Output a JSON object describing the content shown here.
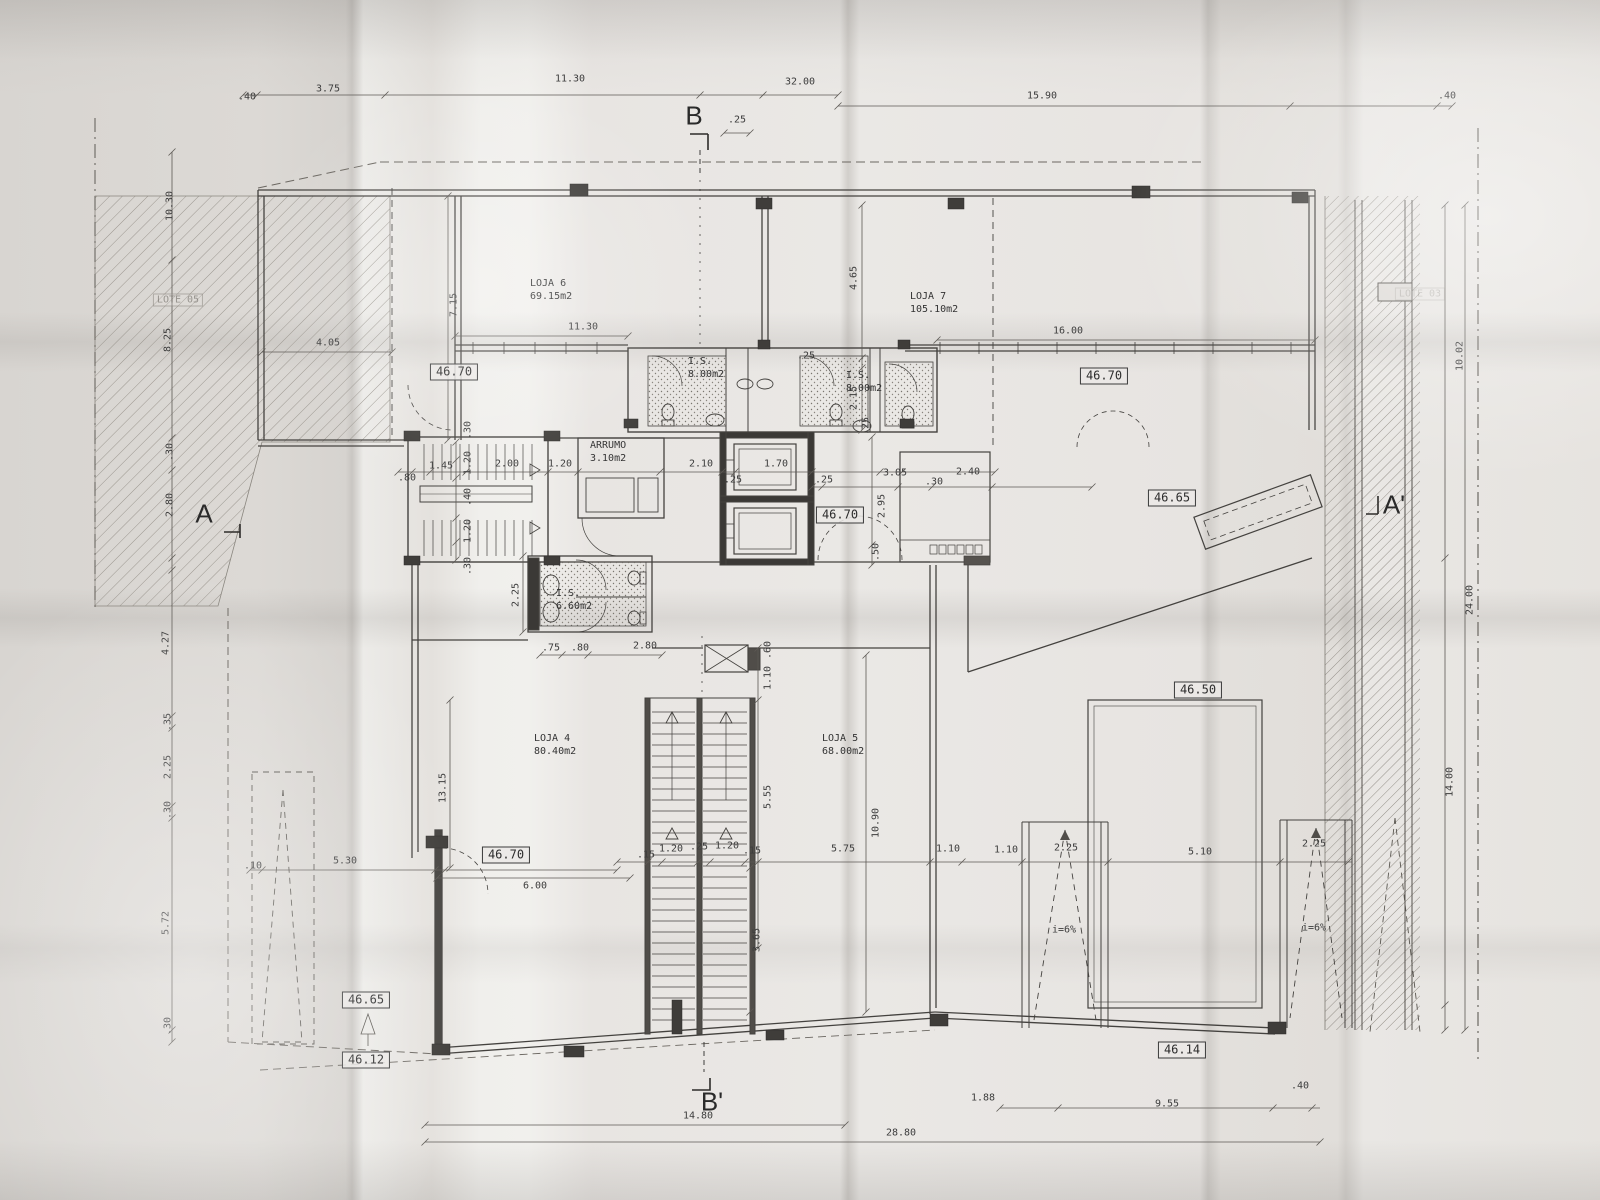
{
  "section_markers": [
    {
      "t": "B",
      "x": 694,
      "y": 116
    },
    {
      "t": "B'",
      "x": 712,
      "y": 1102
    },
    {
      "t": "A",
      "x": 204,
      "y": 514
    },
    {
      "t": "A'",
      "x": 1394,
      "y": 505
    }
  ],
  "room_labels": [
    {
      "t": "LOJA 6\n69.15m2",
      "x": 530,
      "y": 290
    },
    {
      "t": "LOJA 7\n105.10m2",
      "x": 910,
      "y": 303
    },
    {
      "t": "LOJA 4\n80.40m2",
      "x": 534,
      "y": 745
    },
    {
      "t": "LOJA 5\n68.00m2",
      "x": 822,
      "y": 745
    },
    {
      "t": "I.S.\n8.00m2",
      "x": 688,
      "y": 368
    },
    {
      "t": "I.S.\n8.00m2",
      "x": 846,
      "y": 382
    },
    {
      "t": "I.S.\n6.60m2",
      "x": 556,
      "y": 600
    },
    {
      "t": "ARRUMO\n3.10m2",
      "x": 590,
      "y": 452
    }
  ],
  "level_markers": [
    {
      "t": "46.70",
      "x": 454,
      "y": 372
    },
    {
      "t": "46.70",
      "x": 1104,
      "y": 376
    },
    {
      "t": "46.65",
      "x": 1172,
      "y": 498
    },
    {
      "t": "46.70",
      "x": 840,
      "y": 515
    },
    {
      "t": "46.50",
      "x": 1198,
      "y": 690
    },
    {
      "t": "46.70",
      "x": 506,
      "y": 855
    },
    {
      "t": "46.65",
      "x": 366,
      "y": 1000
    },
    {
      "t": "46.12",
      "x": 366,
      "y": 1060
    },
    {
      "t": "46.14",
      "x": 1182,
      "y": 1050
    }
  ],
  "lot_labels": [
    {
      "t": "LOTE 05",
      "x": 178,
      "y": 300,
      "o": 0.6
    },
    {
      "t": "LOTE 03",
      "x": 1420,
      "y": 294,
      "o": 0.3
    }
  ],
  "slope_labels": [
    {
      "t": "i=6%",
      "x": 1064,
      "y": 930
    },
    {
      "t": "i=6%",
      "x": 1314,
      "y": 928
    }
  ],
  "dims_h": [
    {
      "t": ".40",
      "x": 247,
      "y": 97
    },
    {
      "t": "3.75",
      "x": 328,
      "y": 89
    },
    {
      "t": "11.30",
      "x": 570,
      "y": 79
    },
    {
      "t": "32.00",
      "x": 800,
      "y": 82
    },
    {
      "t": ".25",
      "x": 737,
      "y": 120
    },
    {
      "t": "15.90",
      "x": 1042,
      "y": 96
    },
    {
      "t": ".40",
      "x": 1447,
      "y": 96
    },
    {
      "t": "4.05",
      "x": 328,
      "y": 343
    },
    {
      "t": "11.30",
      "x": 583,
      "y": 327
    },
    {
      "t": "16.00",
      "x": 1068,
      "y": 331
    },
    {
      "t": ".80",
      "x": 407,
      "y": 478
    },
    {
      "t": "1.45",
      "x": 441,
      "y": 466
    },
    {
      "t": "2.00",
      "x": 507,
      "y": 464
    },
    {
      "t": "1.20",
      "x": 560,
      "y": 464
    },
    {
      "t": "2.10",
      "x": 701,
      "y": 464
    },
    {
      "t": ".25",
      "x": 733,
      "y": 480
    },
    {
      "t": "1.70",
      "x": 776,
      "y": 464
    },
    {
      "t": ".25",
      "x": 806,
      "y": 356
    },
    {
      "t": ".25",
      "x": 824,
      "y": 480
    },
    {
      "t": "3.05",
      "x": 895,
      "y": 473
    },
    {
      "t": ".30",
      "x": 934,
      "y": 482
    },
    {
      "t": "2.40",
      "x": 968,
      "y": 472
    },
    {
      "t": ".75",
      "x": 551,
      "y": 648
    },
    {
      "t": ".80",
      "x": 580,
      "y": 648
    },
    {
      "t": "2.80",
      "x": 645,
      "y": 646
    },
    {
      "t": "5.30",
      "x": 345,
      "y": 861
    },
    {
      "t": ".10",
      "x": 253,
      "y": 866
    },
    {
      "t": "6.00",
      "x": 535,
      "y": 886
    },
    {
      "t": ".15",
      "x": 646,
      "y": 855
    },
    {
      "t": "1.20",
      "x": 671,
      "y": 849
    },
    {
      "t": ".25",
      "x": 699,
      "y": 847
    },
    {
      "t": "1.20",
      "x": 727,
      "y": 846
    },
    {
      "t": ".15",
      "x": 752,
      "y": 851
    },
    {
      "t": "5.75",
      "x": 843,
      "y": 849
    },
    {
      "t": "1.10",
      "x": 948,
      "y": 849
    },
    {
      "t": "1.10",
      "x": 1006,
      "y": 850
    },
    {
      "t": "2.25",
      "x": 1066,
      "y": 848
    },
    {
      "t": "5.10",
      "x": 1200,
      "y": 852
    },
    {
      "t": "2.25",
      "x": 1314,
      "y": 844
    },
    {
      "t": "1.88",
      "x": 983,
      "y": 1098
    },
    {
      "t": "9.55",
      "x": 1167,
      "y": 1104
    },
    {
      "t": ".40",
      "x": 1300,
      "y": 1086
    },
    {
      "t": "14.80",
      "x": 698,
      "y": 1116
    },
    {
      "t": "28.80",
      "x": 901,
      "y": 1133
    }
  ],
  "dims_v": [
    {
      "t": "10.30",
      "x": 170,
      "y": 206
    },
    {
      "t": "8.25",
      "x": 168,
      "y": 340
    },
    {
      "t": ".30",
      "x": 170,
      "y": 452
    },
    {
      "t": "2.80",
      "x": 170,
      "y": 505
    },
    {
      "t": "4.27",
      "x": 166,
      "y": 643
    },
    {
      "t": ".35",
      "x": 168,
      "y": 722
    },
    {
      "t": "2.25",
      "x": 168,
      "y": 767
    },
    {
      "t": ".30",
      "x": 168,
      "y": 810
    },
    {
      "t": "5.72",
      "x": 166,
      "y": 923
    },
    {
      "t": ".30",
      "x": 168,
      "y": 1026
    },
    {
      "t": "7.15",
      "x": 454,
      "y": 305
    },
    {
      "t": "4.65",
      "x": 854,
      "y": 278
    },
    {
      "t": "2.15",
      "x": 854,
      "y": 398
    },
    {
      "t": ".25",
      "x": 866,
      "y": 426
    },
    {
      "t": ".30",
      "x": 468,
      "y": 430
    },
    {
      "t": "1.20",
      "x": 468,
      "y": 463
    },
    {
      "t": ".40",
      "x": 468,
      "y": 497
    },
    {
      "t": "1.20",
      "x": 468,
      "y": 531
    },
    {
      "t": ".30",
      "x": 468,
      "y": 566
    },
    {
      "t": "2.95",
      "x": 882,
      "y": 506
    },
    {
      "t": ".50",
      "x": 876,
      "y": 552
    },
    {
      "t": "2.25",
      "x": 516,
      "y": 595
    },
    {
      "t": ".60",
      "x": 768,
      "y": 650
    },
    {
      "t": "1.10",
      "x": 768,
      "y": 678
    },
    {
      "t": "5.55",
      "x": 768,
      "y": 797
    },
    {
      "t": "10.90",
      "x": 876,
      "y": 823
    },
    {
      "t": "13.15",
      "x": 443,
      "y": 788
    },
    {
      "t": "3.65",
      "x": 757,
      "y": 940
    },
    {
      "t": "24.00",
      "x": 1470,
      "y": 600
    },
    {
      "t": "14.00",
      "x": 1450,
      "y": 782
    },
    {
      "t": "10.02",
      "x": 1460,
      "y": 356
    }
  ]
}
